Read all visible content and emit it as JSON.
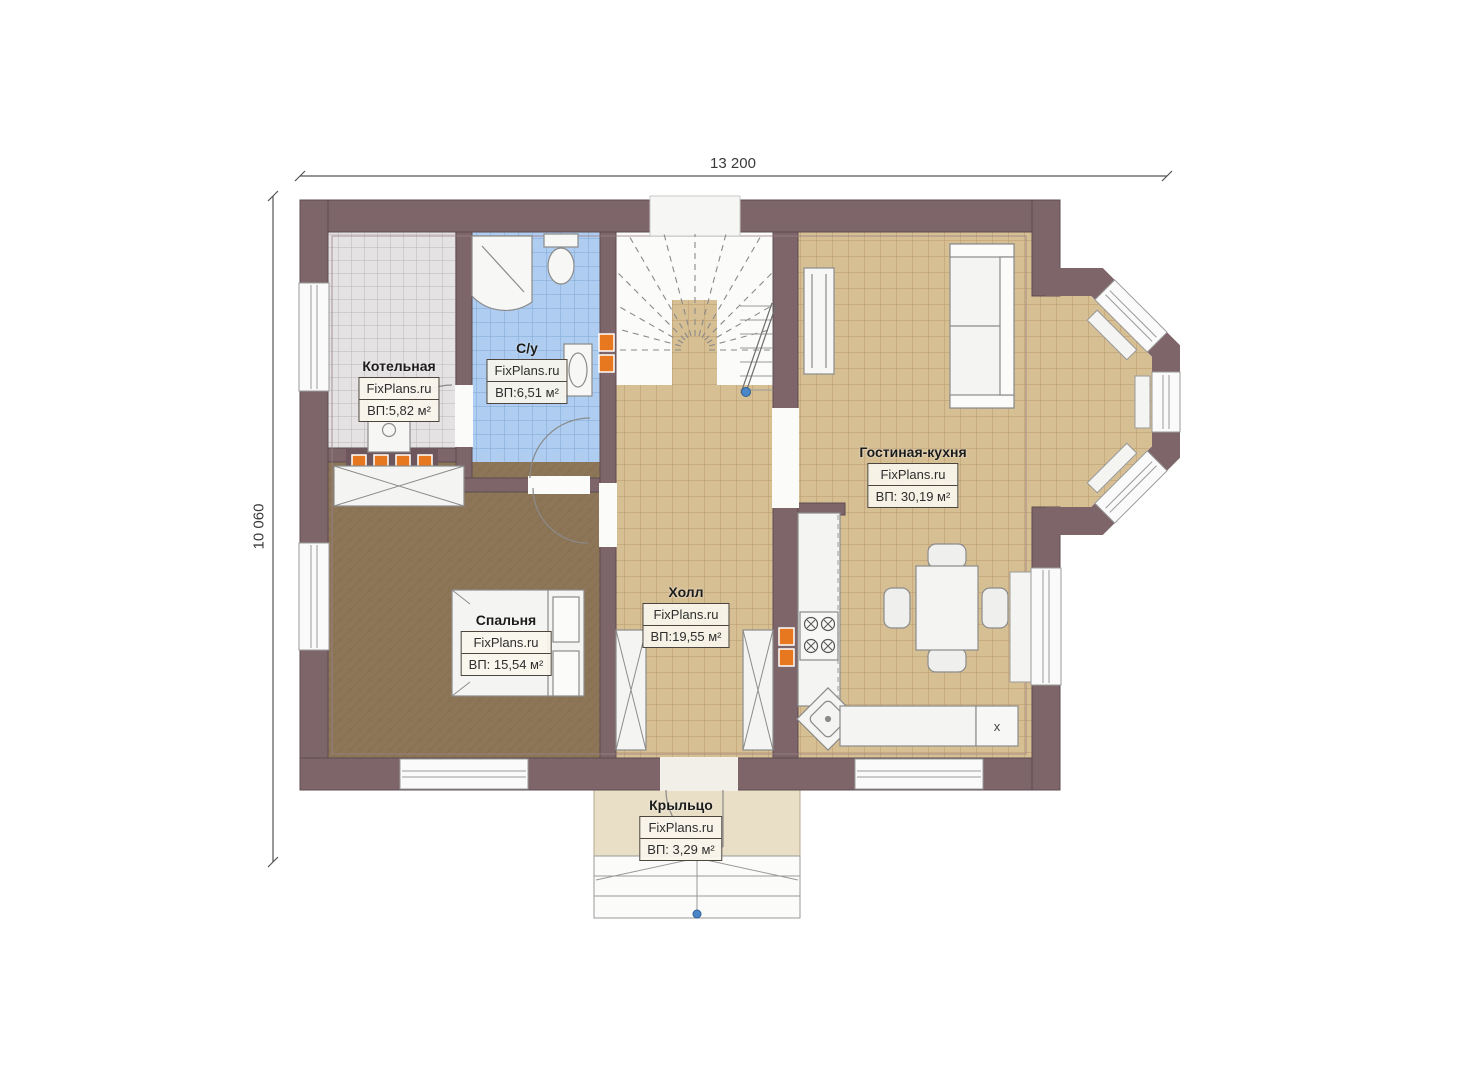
{
  "plan": {
    "dimensions": {
      "width_label": "13 200",
      "height_label": "10 060"
    },
    "rooms": [
      {
        "id": "boiler",
        "name": "Котельная",
        "watermark": "FixPlans.ru",
        "area": "ВП:5,82 м²"
      },
      {
        "id": "bathroom",
        "name": "С/у",
        "watermark": "FixPlans.ru",
        "area": "ВП:6,51 м²"
      },
      {
        "id": "hall",
        "name": "Холл",
        "watermark": "FixPlans.ru",
        "area": "ВП:19,55 м²"
      },
      {
        "id": "bedroom",
        "name": "Спальня",
        "watermark": "FixPlans.ru",
        "area": "ВП: 15,54 м²"
      },
      {
        "id": "living_kitchen",
        "name": "Гостиная-кухня",
        "watermark": "FixPlans.ru",
        "area": "ВП: 30,19 м²"
      },
      {
        "id": "porch",
        "name": "Крыльцо",
        "watermark": "FixPlans.ru",
        "area": "ВП: 3,29 м²"
      }
    ],
    "kitchen": {
      "appliance_label": "x"
    },
    "colors": {
      "wall": "#7d6569",
      "wall_edge": "#5d4c51",
      "floor_tan": "#d7bf94",
      "floor_brown": "#8d7557",
      "tile_blue": "#aecdf0",
      "tile_gray": "#e4e2e3",
      "porch_beige": "#e9dec6",
      "accent_orange": "#e8781f",
      "marker_blue": "#4a86c8"
    }
  }
}
